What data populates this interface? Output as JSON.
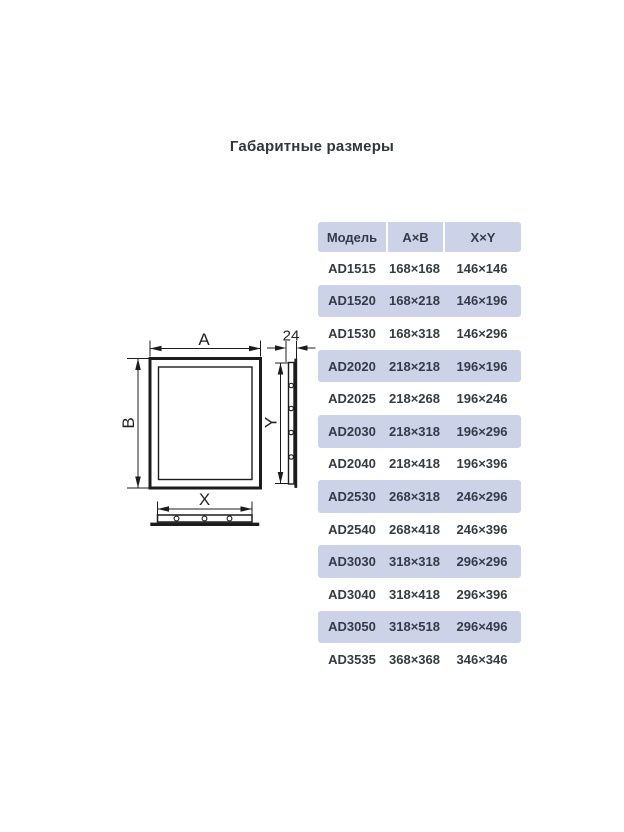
{
  "page": {
    "title": "Габаритные размеры"
  },
  "diagram": {
    "labels": {
      "a": "A",
      "b": "B",
      "x": "X",
      "y": "Y",
      "depth": "24"
    },
    "colors": {
      "stroke": "#1c1c1c"
    }
  },
  "table": {
    "header": {
      "model": "Модель",
      "ab": "A×B",
      "xy": "X×Y"
    },
    "colors": {
      "header_bg": "#ccd3e8",
      "alt_row_bg": "#ccd3e8",
      "text": "#343a46"
    },
    "rows": [
      {
        "model": "AD1515",
        "ab": "168×168",
        "xy": "146×146"
      },
      {
        "model": "AD1520",
        "ab": "168×218",
        "xy": "146×196"
      },
      {
        "model": "AD1530",
        "ab": "168×318",
        "xy": "146×296"
      },
      {
        "model": "AD2020",
        "ab": "218×218",
        "xy": "196×196"
      },
      {
        "model": "AD2025",
        "ab": "218×268",
        "xy": "196×246"
      },
      {
        "model": "AD2030",
        "ab": "218×318",
        "xy": "196×296"
      },
      {
        "model": "AD2040",
        "ab": "218×418",
        "xy": "196×396"
      },
      {
        "model": "AD2530",
        "ab": "268×318",
        "xy": "246×296"
      },
      {
        "model": "AD2540",
        "ab": "268×418",
        "xy": "246×396"
      },
      {
        "model": "AD3030",
        "ab": "318×318",
        "xy": "296×296"
      },
      {
        "model": "AD3040",
        "ab": "318×418",
        "xy": "296×396"
      },
      {
        "model": "AD3050",
        "ab": "318×518",
        "xy": "296×496"
      },
      {
        "model": "AD3535",
        "ab": "368×368",
        "xy": "346×346"
      }
    ]
  }
}
